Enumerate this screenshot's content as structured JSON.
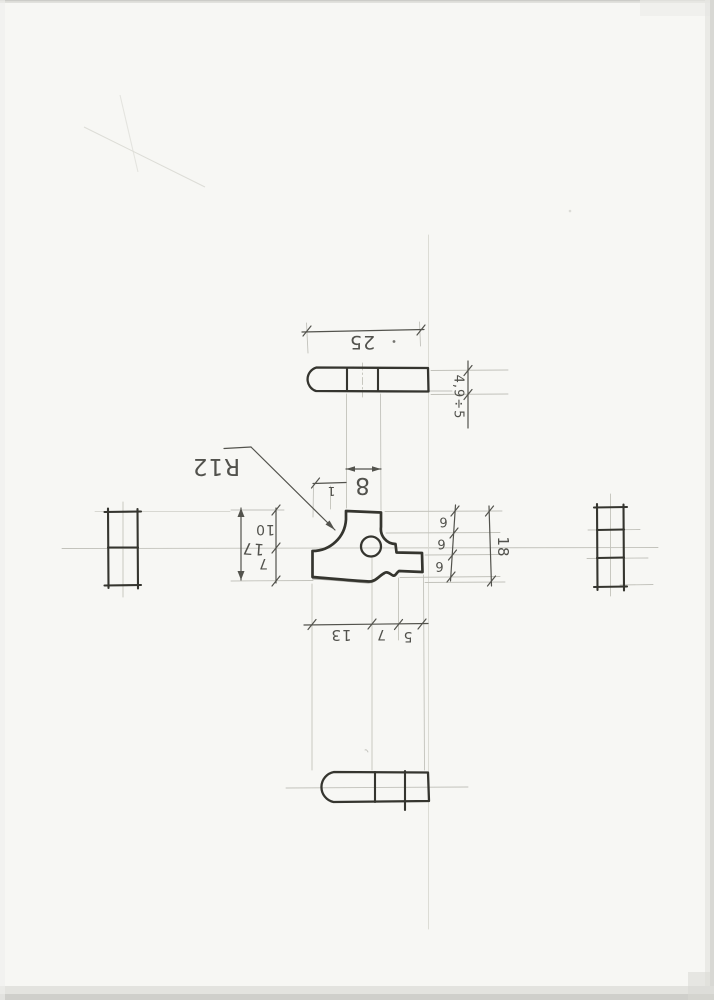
{
  "labels": {
    "top_view": {
      "length": "25",
      "thickness": "4,9÷5"
    },
    "front_view": {
      "fillet_radius": "R12",
      "tab_width": "8",
      "tab_offset": "1",
      "left_total": "17",
      "left_upper": "10",
      "left_lower": "7",
      "right_steps": [
        "6",
        "6",
        "6"
      ],
      "right_total": "18",
      "bottom_segments": [
        "13",
        "7",
        "5"
      ]
    }
  },
  "colors": {
    "paper": "#f7f7f4",
    "pencil_dark": "#35352f",
    "pencil_med": "#53534d",
    "pencil_faint": "#c2c2bb",
    "text": "#45453f"
  }
}
